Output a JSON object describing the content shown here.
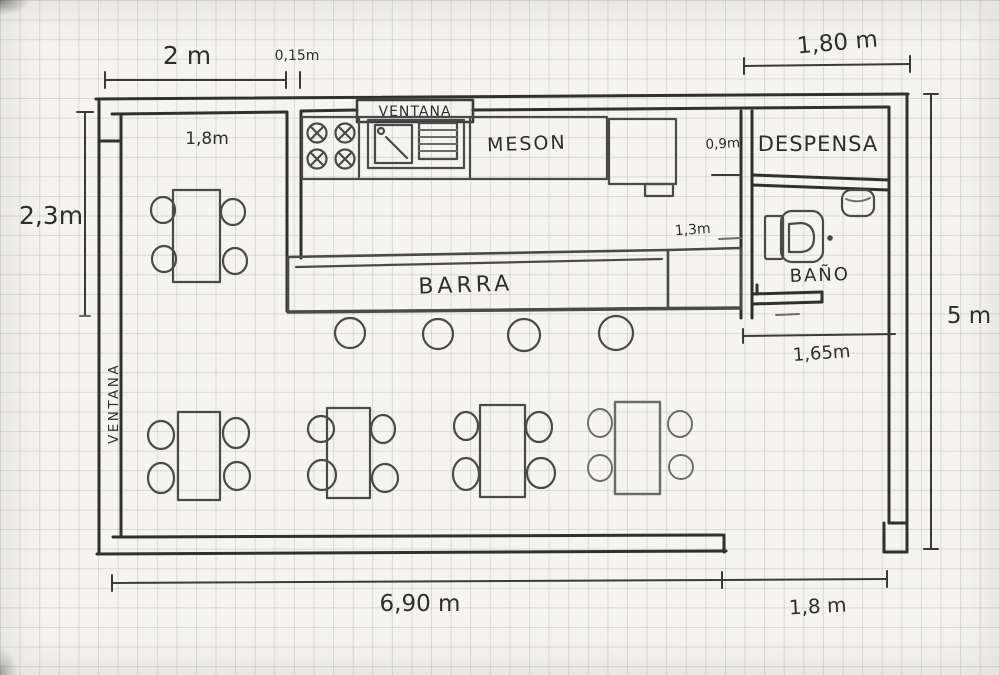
{
  "labels": {
    "ventana_top": "VENTANA",
    "ventana_left": "VENTANA",
    "meson": "MESON",
    "barra": "BARRA",
    "despensa": "DESPENSA",
    "bano": "BAÑO"
  },
  "dimensions": {
    "top_width": "2 m",
    "wall_thickness": "0,15m",
    "pantry_width_top": "1,80 m",
    "left_height": "2,3m",
    "dining_nook_width": "1,8m",
    "pantry_door_width": "0,9m",
    "bar_to_wall_gap": "1,3m",
    "bathroom_width": "1,65m",
    "right_height": "5 m",
    "bottom_width": "6,90 m",
    "entrance_width": "1,8 m"
  },
  "furniture_counts": {
    "dining_tables": 5,
    "chairs_per_table": 4,
    "bar_stools": 4,
    "stove_burners": 4
  }
}
